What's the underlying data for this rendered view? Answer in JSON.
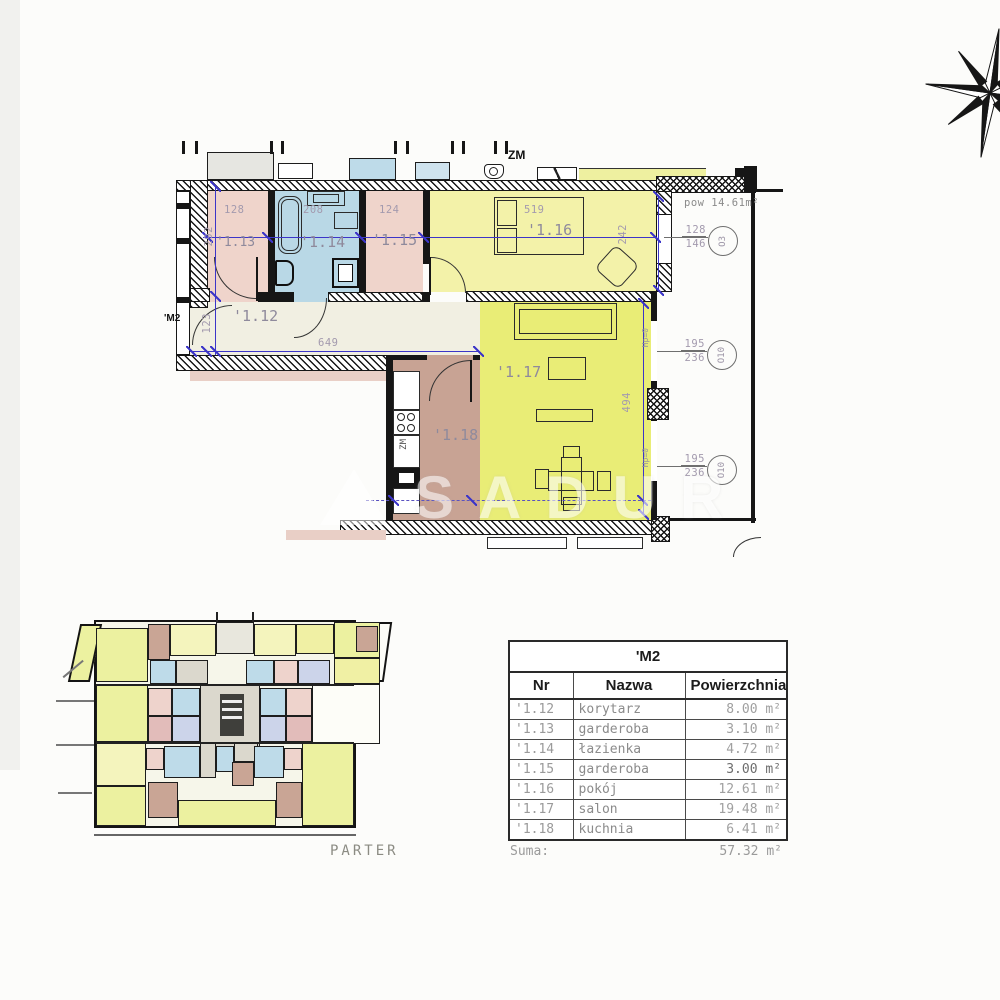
{
  "plan": {
    "unit_label": "'M2",
    "zm_label": "ZM",
    "kitchen_zm": "ZM",
    "terrace_area": "pow 14.61m²",
    "sill": "Hp=0",
    "rooms": {
      "r12": "'1.12",
      "r13": "'1.13",
      "r14": "'1.14",
      "r15": "'1.15",
      "r16": "'1.16",
      "r17": "'1.17",
      "r18": "'1.18"
    },
    "dims": {
      "w13": "128",
      "w14": "208",
      "w15": "124",
      "w16": "519",
      "h_rooms": "292",
      "h16": "242",
      "h_corr": "123",
      "w_corr": "649",
      "h17": "494"
    },
    "windows": [
      {
        "w": "128",
        "h": "146",
        "code": "O3"
      },
      {
        "w": "195",
        "h": "236",
        "code": "O10"
      },
      {
        "w": "195",
        "h": "236",
        "code": "O10"
      }
    ]
  },
  "overview": {
    "caption": "PARTER"
  },
  "watermark": {
    "text": "SADUR"
  },
  "table": {
    "title": "'M2",
    "columns": {
      "nr": "Nr",
      "name": "Nazwa",
      "area": "Powierzchnia"
    },
    "area_unit": "m²",
    "rows": [
      {
        "nr": "'1.12",
        "name": "korytarz",
        "area": "8.00"
      },
      {
        "nr": "'1.13",
        "name": "garderoba",
        "area": "3.10"
      },
      {
        "nr": "'1.14",
        "name": "łazienka",
        "area": "4.72"
      },
      {
        "nr": "'1.15",
        "name": "garderoba",
        "area": "3.00"
      },
      {
        "nr": "'1.16",
        "name": "pokój",
        "area": "12.61"
      },
      {
        "nr": "'1.17",
        "name": "salon",
        "area": "19.48"
      },
      {
        "nr": "'1.18",
        "name": "kuchnia",
        "area": "6.41"
      }
    ],
    "sum_label": "Suma:",
    "sum_value": "57.32"
  }
}
